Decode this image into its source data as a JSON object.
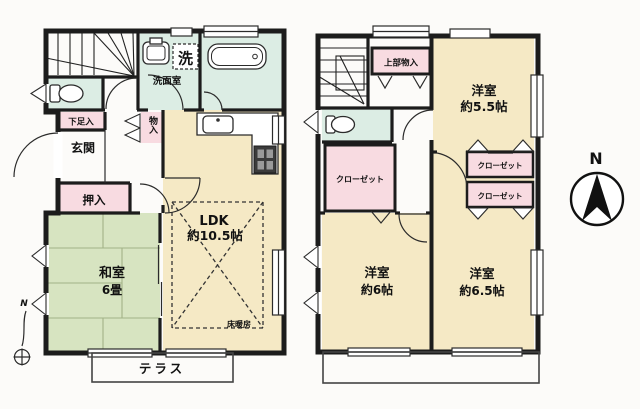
{
  "plan": {
    "compass_label": "N",
    "site_marker_label": "N",
    "colors": {
      "wall": "#1c1c1c",
      "room_yellow": "#f5e9c5",
      "room_mint": "#dcede4",
      "tatami_green": "#d7e4c1",
      "closet_pink": "#f8dbe1"
    },
    "floor1": {
      "entrance": "玄関",
      "shoe_storage": "下足入",
      "oshiire": "押入",
      "tatami_name": "和室",
      "tatami_size": "6畳",
      "ldk_name": "LDK",
      "ldk_size": "約10.5帖",
      "floor_heating": "床暖房",
      "washroom": "洗面室",
      "laundry": "洗",
      "storage": "物入",
      "terrace": "テラス"
    },
    "floor2": {
      "upper_storage": "上部物入",
      "bedroom_a_name": "洋室",
      "bedroom_a_size": "約5.5帖",
      "bedroom_b_name": "洋室",
      "bedroom_b_size": "約6帖",
      "bedroom_c_name": "洋室",
      "bedroom_c_size": "約6.5帖",
      "closet_left": "クローゼット",
      "closet_mid_upper": "クローゼット",
      "closet_mid_lower": "クローゼット"
    }
  }
}
